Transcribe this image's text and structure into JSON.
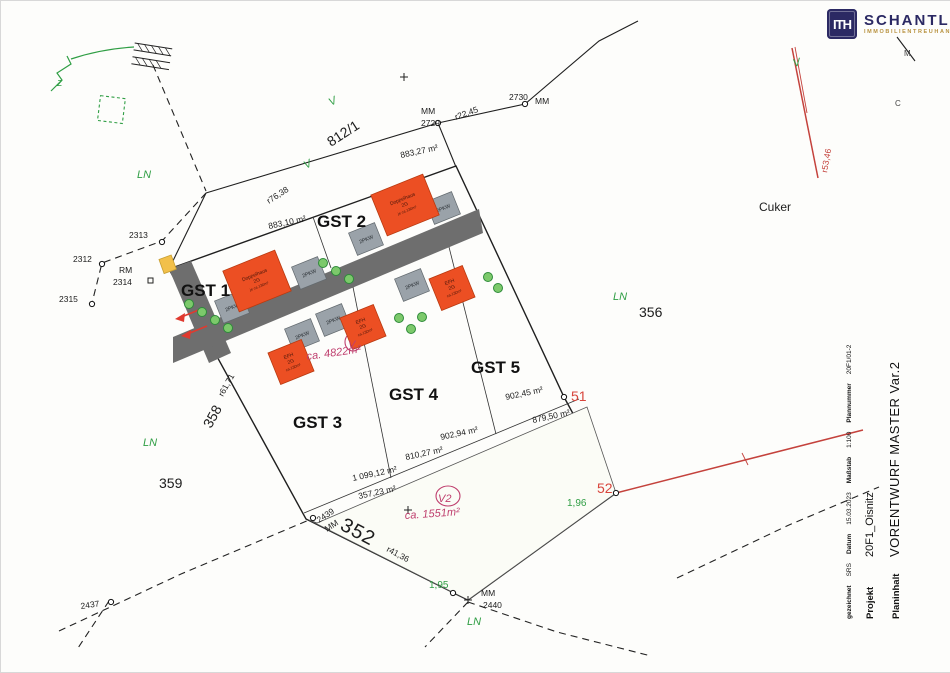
{
  "logo": {
    "monogram": "ITH",
    "name": "SCHANTL",
    "tagline": "IMMOBILIENTREUHAND",
    "navy": "#2b2963",
    "gold": "#b8923f"
  },
  "titleblock": {
    "planinhalt_label": "Planinhalt",
    "planinhalt_value": "VORENTWURF MASTER Var.2",
    "projekt_label": "Projekt",
    "projekt_value": "20F1_Oisnitz",
    "meta": [
      {
        "label": "gezeichnet",
        "value": "SRS"
      },
      {
        "label": "Datum",
        "value": "15.03.2023"
      },
      {
        "label": "Maßstab",
        "value": "1:100"
      },
      {
        "label": "Plannummer",
        "value": "20F1/01-2"
      }
    ]
  },
  "plan": {
    "colors": {
      "parcel": "#def0d4",
      "parcel_stroke": "#1f1f1f",
      "v2_area": "#fbfcf6",
      "road": "#6e6e6e",
      "house": "#ec4f23",
      "house_stroke": "#b83a10",
      "carport": "#9aa2a9",
      "carport_stroke": "#62696e",
      "tree_fill": "#7cc96b",
      "tree_stroke": "#2e8b3a",
      "accent_red": "#d8453c",
      "accent_green": "#2f9e44",
      "accent_magenta": "#bf3f6e",
      "line_red": "#c4423c",
      "marker_yellow": "#f2c04a"
    },
    "carport_size": {
      "w": 28,
      "h": 24,
      "r": -22,
      "label": "2PKW"
    },
    "houses": [
      {
        "id": "house-gst1",
        "x": 256,
        "y": 280,
        "w": 56,
        "h": 44,
        "r": -22,
        "lines": [
          "Doppelhaus",
          "2G",
          "je ca.130m²"
        ]
      },
      {
        "id": "house-gst2",
        "x": 404,
        "y": 204,
        "w": 56,
        "h": 44,
        "r": -22,
        "lines": [
          "Doppelhaus",
          "2G",
          "je ca.130m²"
        ]
      },
      {
        "id": "house-gst3",
        "x": 290,
        "y": 361,
        "w": 36,
        "h": 34,
        "r": -22,
        "lines": [
          "EFH",
          "2G",
          "ca.130m²"
        ]
      },
      {
        "id": "house-gst4",
        "x": 362,
        "y": 326,
        "w": 36,
        "h": 34,
        "r": -22,
        "lines": [
          "EFH",
          "2G",
          "ca.130m²"
        ]
      },
      {
        "id": "house-gst5",
        "x": 451,
        "y": 287,
        "w": 36,
        "h": 34,
        "r": -22,
        "lines": [
          "EFH",
          "2G",
          "ca.130m²"
        ]
      }
    ],
    "carports": [
      {
        "id": "carport-gst1-a",
        "x": 231,
        "y": 306
      },
      {
        "id": "carport-gst1-b",
        "x": 308,
        "y": 272
      },
      {
        "id": "carport-gst2-a",
        "x": 365,
        "y": 238
      },
      {
        "id": "carport-gst2-b",
        "x": 442,
        "y": 207
      },
      {
        "id": "carport-gst3",
        "x": 301,
        "y": 334
      },
      {
        "id": "carport-gst4",
        "x": 332,
        "y": 319
      },
      {
        "id": "carport-gst5",
        "x": 411,
        "y": 284
      }
    ],
    "trees": [
      [
        188,
        303
      ],
      [
        201,
        311
      ],
      [
        214,
        319
      ],
      [
        227,
        327
      ],
      [
        322,
        262
      ],
      [
        335,
        270
      ],
      [
        348,
        278
      ],
      [
        398,
        317
      ],
      [
        410,
        328
      ],
      [
        421,
        316
      ],
      [
        487,
        276
      ],
      [
        497,
        287
      ]
    ],
    "labels": [
      {
        "id": "area-883-27",
        "t": "883,27 m²",
        "x": 400,
        "y": 157,
        "r": -12
      },
      {
        "id": "area-883-10",
        "t": "883,10 m²",
        "x": 268,
        "y": 228,
        "r": -12
      },
      {
        "id": "area-902-45",
        "t": "902,45 m²",
        "x": 505,
        "y": 399,
        "r": -12
      },
      {
        "id": "area-879-50",
        "t": "879,50 m²",
        "x": 532,
        "y": 422,
        "r": -12
      },
      {
        "id": "area-902-94",
        "t": "902,94 m²",
        "x": 440,
        "y": 439,
        "r": -12
      },
      {
        "id": "area-810-27",
        "t": "810,27 m²",
        "x": 405,
        "y": 459,
        "r": -12
      },
      {
        "id": "area-1099-12",
        "t": "1 099,12 m²",
        "x": 352,
        "y": 480,
        "r": -12
      },
      {
        "id": "area-357-23",
        "t": "357,23 m²",
        "x": 358,
        "y": 498,
        "r": -12
      },
      {
        "id": "pt2312",
        "t": "2312",
        "x": 72,
        "y": 261
      },
      {
        "id": "pt2313",
        "t": "2313",
        "x": 128,
        "y": 237
      },
      {
        "id": "pt2315",
        "t": "2315",
        "x": 58,
        "y": 301
      },
      {
        "id": "rm",
        "t": "RM",
        "x": 118,
        "y": 272
      },
      {
        "id": "pt2314",
        "t": "2314",
        "x": 112,
        "y": 284
      },
      {
        "id": "pt2437",
        "t": "2437",
        "x": 80,
        "y": 608,
        "r": -8
      },
      {
        "id": "pt2439",
        "t": "2439",
        "x": 318,
        "y": 522,
        "r": -33
      },
      {
        "id": "pt2439mm",
        "t": "MM",
        "x": 326,
        "y": 531,
        "r": -33
      },
      {
        "id": "mm2440a",
        "t": "MM",
        "x": 480,
        "y": 595
      },
      {
        "id": "pt2440",
        "t": "2440",
        "x": 482,
        "y": 607
      },
      {
        "id": "mm2729a",
        "t": "MM",
        "x": 420,
        "y": 113
      },
      {
        "id": "pt2729",
        "t": "2729",
        "x": 420,
        "y": 125
      },
      {
        "id": "pt2730",
        "t": "2730",
        "x": 508,
        "y": 99
      },
      {
        "id": "mm2730",
        "t": "MM",
        "x": 534,
        "y": 103
      },
      {
        "id": "p8121",
        "t": "812/1",
        "x": 330,
        "y": 146,
        "r": -33,
        "cls": "big"
      },
      {
        "id": "r7638",
        "t": "r76,38",
        "x": 268,
        "y": 203,
        "r": -33
      },
      {
        "id": "r2245",
        "t": "r22,45",
        "x": 455,
        "y": 119,
        "r": -20
      },
      {
        "id": "r5346",
        "t": "r53,46",
        "x": 826,
        "y": 172,
        "r": -80,
        "cls": "redlbl"
      },
      {
        "id": "r6171",
        "t": "r61,71",
        "x": 222,
        "y": 396,
        "r": -61
      },
      {
        "id": "p358",
        "t": "358",
        "x": 210,
        "y": 428,
        "r": -61,
        "cls": "big"
      },
      {
        "id": "p359",
        "t": "359",
        "x": 158,
        "y": 487,
        "cls": "big"
      },
      {
        "id": "p352",
        "t": "352",
        "x": 338,
        "y": 528,
        "r": 28,
        "cls": "big2"
      },
      {
        "id": "r4136",
        "t": "r41,36",
        "x": 385,
        "y": 550,
        "r": 28
      },
      {
        "id": "p356",
        "t": "356",
        "x": 638,
        "y": 316,
        "cls": "big"
      },
      {
        "id": "cuker",
        "t": "Cuker",
        "x": 758,
        "y": 210,
        "cls": "med"
      },
      {
        "id": "pt51",
        "t": "51",
        "x": 570,
        "y": 400,
        "cls": "redbig"
      },
      {
        "id": "pt52",
        "t": "52",
        "x": 596,
        "y": 492,
        "cls": "redbig"
      },
      {
        "id": "d196",
        "t": "1,96",
        "x": 566,
        "y": 505,
        "cls": "greenp"
      },
      {
        "id": "d195",
        "t": "1,95",
        "x": 428,
        "y": 587,
        "cls": "greenp"
      },
      {
        "id": "ln1",
        "t": "LN",
        "x": 136,
        "y": 177,
        "cls": "green"
      },
      {
        "id": "ln2",
        "t": "LN",
        "x": 142,
        "y": 445,
        "cls": "green"
      },
      {
        "id": "ln3",
        "t": "LN",
        "x": 612,
        "y": 299,
        "cls": "green"
      },
      {
        "id": "ln4",
        "t": "LN",
        "x": 466,
        "y": 624,
        "cls": "green"
      },
      {
        "id": "gst1",
        "t": "GST 1",
        "x": 180,
        "y": 295,
        "cls": "gst"
      },
      {
        "id": "gst2",
        "t": "GST 2",
        "x": 316,
        "y": 226,
        "cls": "gst"
      },
      {
        "id": "gst3",
        "t": "GST 3",
        "x": 292,
        "y": 427,
        "cls": "gst"
      },
      {
        "id": "gst4",
        "t": "GST 4",
        "x": 388,
        "y": 399,
        "cls": "gst"
      },
      {
        "id": "gst5",
        "t": "GST 5",
        "x": 470,
        "y": 372,
        "cls": "gst"
      },
      {
        "id": "n4822",
        "t": "ca. 4822m²",
        "x": 306,
        "y": 359,
        "r": -8,
        "cls": "magenta"
      },
      {
        "id": "nV",
        "t": "V",
        "x": 347,
        "y": 347,
        "cls": "magenta"
      },
      {
        "id": "nV2",
        "t": "V2",
        "x": 437,
        "y": 501,
        "cls": "magenta"
      },
      {
        "id": "n1551",
        "t": "ca. 1551m²",
        "x": 404,
        "y": 518,
        "r": -4,
        "cls": "magenta"
      },
      {
        "id": "vg1",
        "t": "V",
        "x": 330,
        "y": 105,
        "r": -28,
        "cls": "green"
      },
      {
        "id": "vg2",
        "t": "V",
        "x": 305,
        "y": 168,
        "r": -28,
        "cls": "green"
      },
      {
        "id": "vg3",
        "t": "V",
        "x": 793,
        "y": 66,
        "r": -15,
        "cls": "green"
      },
      {
        "id": "zg",
        "t": "z",
        "x": 56,
        "y": 85,
        "cls": "green"
      },
      {
        "id": "corner-m",
        "t": "M",
        "x": 903,
        "y": 55,
        "cls": "sm"
      },
      {
        "id": "corner-c",
        "t": "C",
        "x": 894,
        "y": 105,
        "cls": "sm"
      }
    ]
  }
}
